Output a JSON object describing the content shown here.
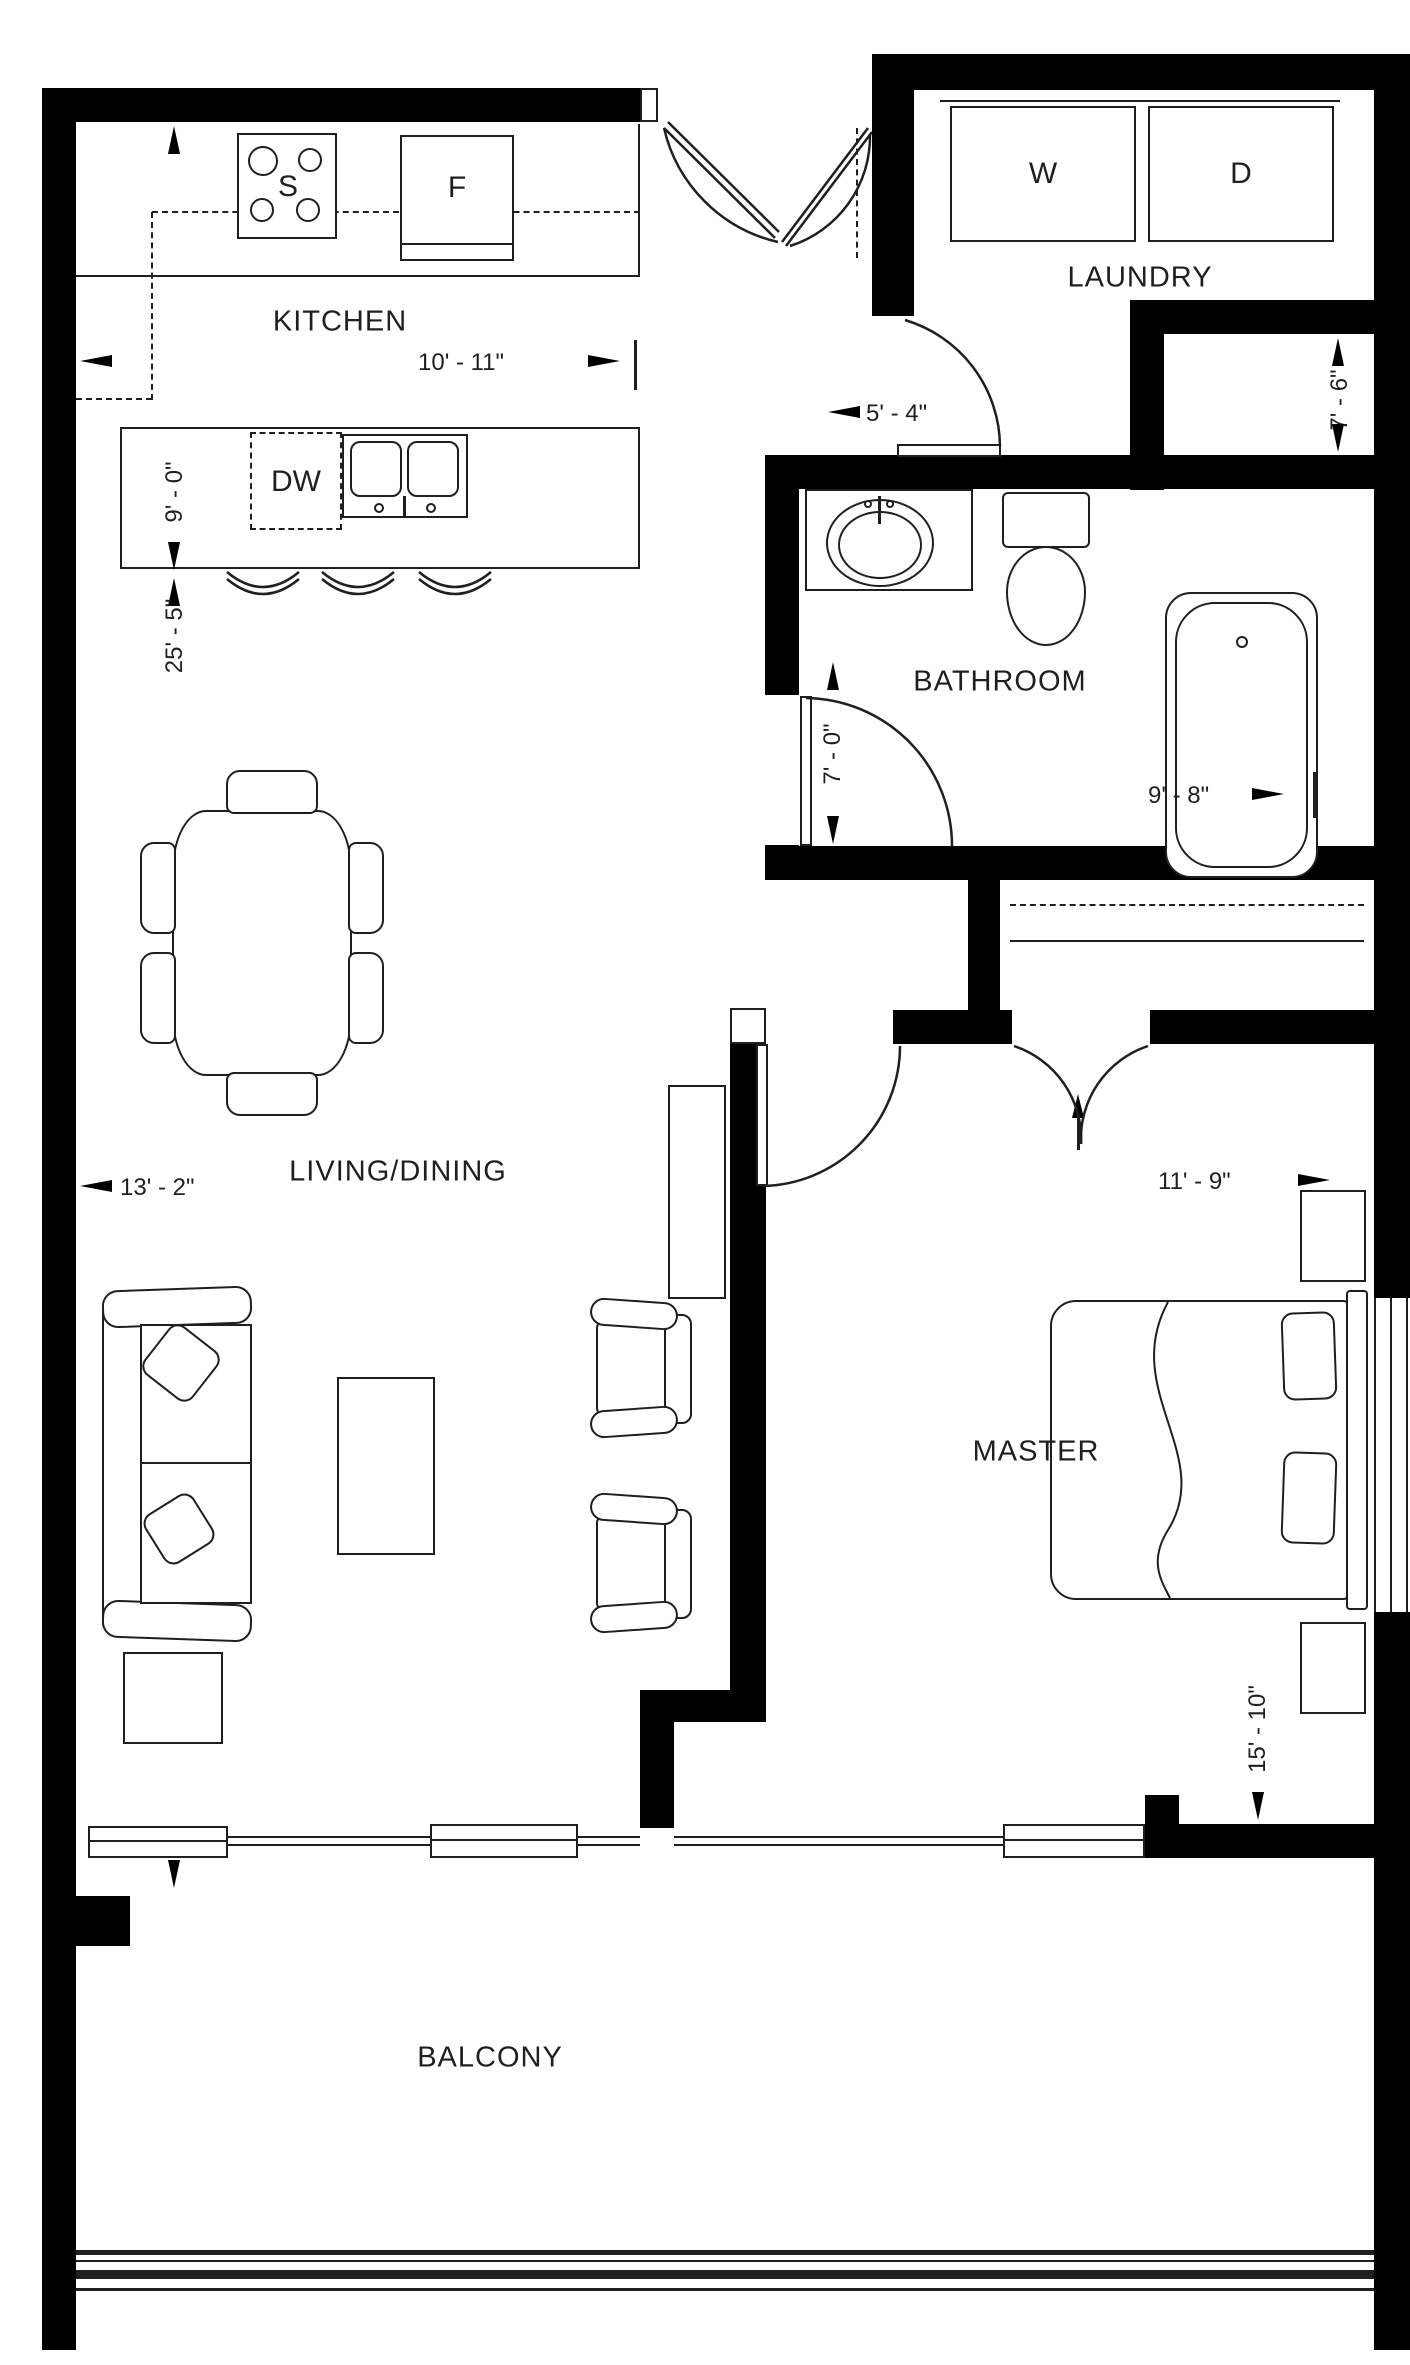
{
  "plan": {
    "title": "One-bedroom apartment floor plan",
    "rooms": {
      "kitchen": {
        "label": "KITCHEN"
      },
      "laundry": {
        "label": "LAUNDRY"
      },
      "bathroom": {
        "label": "BATHROOM"
      },
      "living_dining": {
        "label": "LIVING/DINING"
      },
      "master": {
        "label": "MASTER"
      },
      "balcony": {
        "label": "BALCONY"
      }
    },
    "appliances": {
      "stove": "S",
      "fridge": "F",
      "dishwasher": "DW",
      "washer": "W",
      "dryer": "D"
    },
    "dimensions": {
      "kitchen_width": "10' - 11\"",
      "kitchen_depth": "9' - 0\"",
      "living_length": "25' - 5\"",
      "hall_width": "5' - 4\"",
      "laundry_depth": "7' - 6\"",
      "bathroom_depth": "7' - 0\"",
      "bathroom_width": "9' - 8\"",
      "living_width": "13' - 2\"",
      "master_width": "11' - 9\"",
      "master_depth": "15' - 10\""
    },
    "colors": {
      "wall": "#000000",
      "line": "#1f1f1f",
      "background": "#ffffff"
    }
  }
}
